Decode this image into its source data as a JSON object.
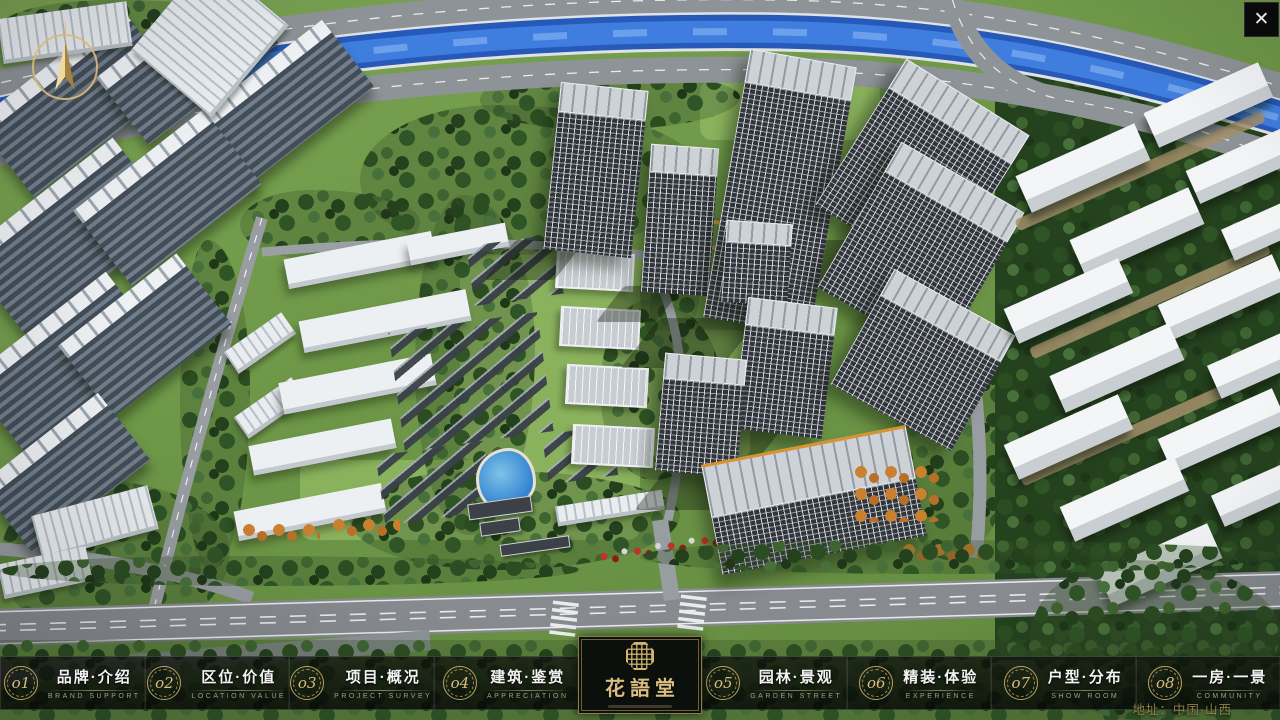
{
  "window": {
    "close_icon": "✕"
  },
  "scene": {
    "address_caption": "地址：中国·山西"
  },
  "logo": {
    "title": "花語堂"
  },
  "nav": {
    "items": [
      {
        "num": "o1",
        "title": "品牌·介绍",
        "subtitle": "BRAND SUPPORT"
      },
      {
        "num": "o2",
        "title": "区位·价值",
        "subtitle": "LOCATION VALUE"
      },
      {
        "num": "o3",
        "title": "项目·概况",
        "subtitle": "PROJECT SURVEY"
      },
      {
        "num": "o4",
        "title": "建筑·鉴赏",
        "subtitle": "APPRECIATION"
      },
      {
        "num": "o5",
        "title": "园林·景观",
        "subtitle": "GARDEN STREET"
      },
      {
        "num": "o6",
        "title": "精装·体验",
        "subtitle": "EXPERIENCE"
      },
      {
        "num": "o7",
        "title": "户型·分布",
        "subtitle": "SHOW ROOM"
      },
      {
        "num": "o8",
        "title": "一房·一景",
        "subtitle": "COMMUNITY"
      }
    ]
  },
  "colors": {
    "gold": "#cfae6e",
    "nav_bg": "#0a0e0a",
    "river": "#2e6bd0",
    "accent_red": "#c23028"
  }
}
